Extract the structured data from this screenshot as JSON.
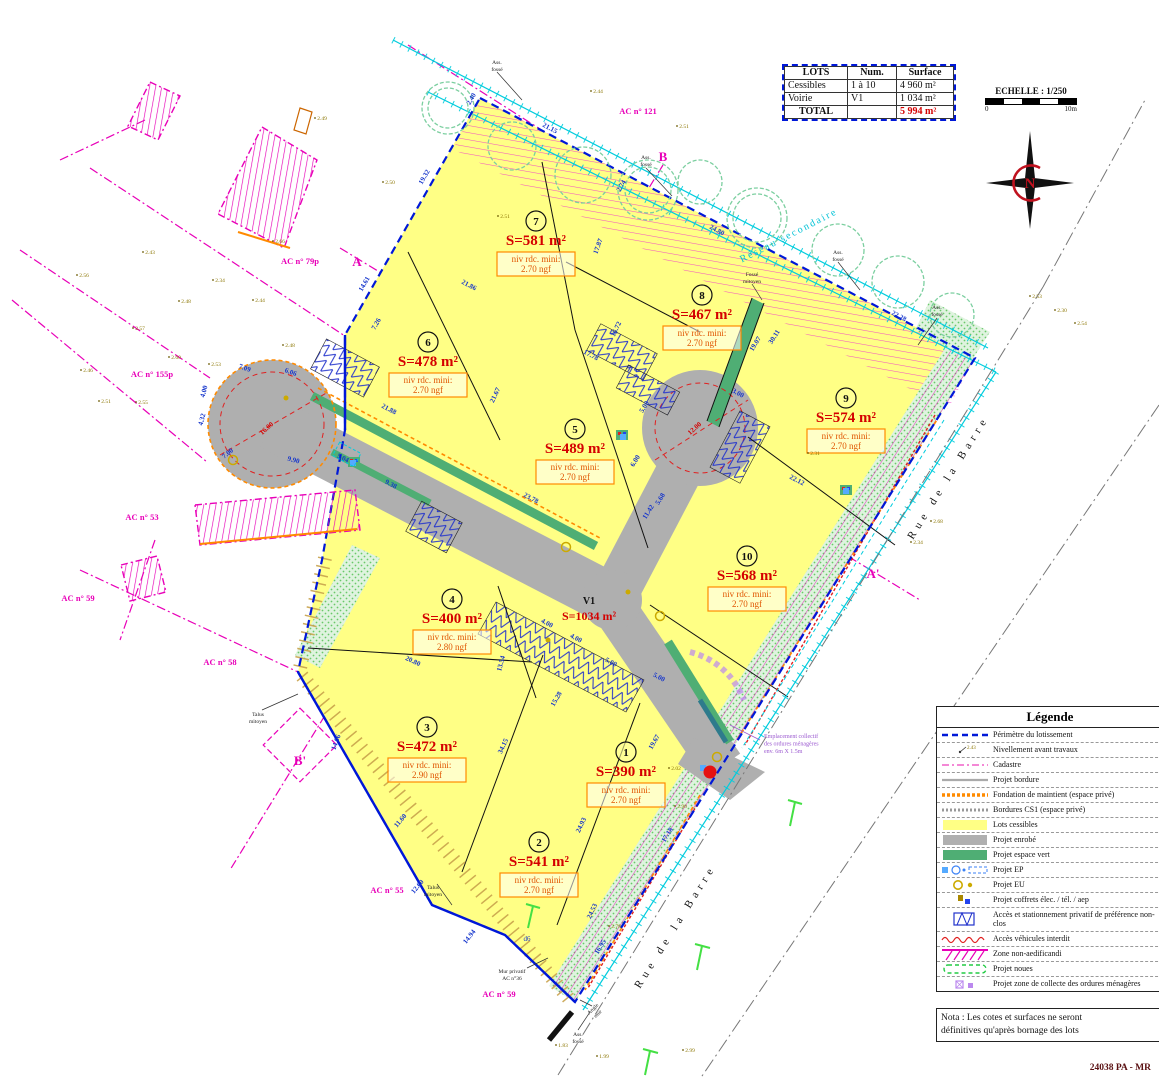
{
  "doc": {
    "ref": "24038 PA - MR"
  },
  "colors": {
    "perimeter": "#0018D8",
    "cadastre": "#E800B8",
    "lots_fill": "#FFFF85",
    "road_fill": "#AFAFAF",
    "green": "#4FAE74",
    "dim_blue": "#1535CC",
    "surface_red": "#D40000",
    "niv_orange": "#E05500",
    "cyan": "#00CCDD",
    "olive": "#8B7500",
    "violet": "#9B59D0"
  },
  "table": {
    "headers": [
      "LOTS",
      "Num.",
      "Surface"
    ],
    "rows": [
      {
        "label": "Cessibles",
        "num": "1 à 10",
        "surface": "4 960 m²"
      },
      {
        "label": "Voirie",
        "num": "V1",
        "surface": "1 034 m²"
      }
    ],
    "total_label": "TOTAL",
    "total_surface": "5 994 m²"
  },
  "scalebar": {
    "label": "ECHELLE : 1/250",
    "start": "0",
    "end": "10m"
  },
  "compass": {
    "label": "N"
  },
  "legend": {
    "title": "Légende",
    "items": [
      {
        "sym": "perimetre",
        "label": "Périmètre du lotissement"
      },
      {
        "sym": "nivellement",
        "label": "Nivellement avant travaux"
      },
      {
        "sym": "cadastre",
        "label": "Cadastre"
      },
      {
        "sym": "bordure",
        "label": "Projet bordure"
      },
      {
        "sym": "fondation",
        "label": "Fondation de maintient (espace privé)"
      },
      {
        "sym": "cs1",
        "label": "Bordures CS1 (espace privé)"
      },
      {
        "sym": "lots",
        "label": "Lots cessibles"
      },
      {
        "sym": "enrobe",
        "label": "Projet enrobé"
      },
      {
        "sym": "vert",
        "label": "Projet espace vert"
      },
      {
        "sym": "ep",
        "label": "Projet EP"
      },
      {
        "sym": "eu",
        "label": "Projet EU"
      },
      {
        "sym": "coffrets",
        "label": "Projet coffrets élec. / tél. / aep"
      },
      {
        "sym": "acces",
        "label": "Accès et stationnement privatif de préférence non-clos"
      },
      {
        "sym": "interdit",
        "label": "Accès véhicules interdit"
      },
      {
        "sym": "zone",
        "label": "Zone non-aedificandi"
      },
      {
        "sym": "noues",
        "label": "Projet noues"
      },
      {
        "sym": "collecte",
        "label": "Projet zone de collecte des ordures ménagères"
      }
    ]
  },
  "nota": {
    "line1": "Nota : Les cotes et surfaces ne seront",
    "line2": "définitives qu'après bornage des lots"
  },
  "lots": [
    {
      "num": "1",
      "surface": "S=390 m²",
      "niv": "niv rdc. mini:",
      "ngf": "2.70 ngf",
      "x": 626,
      "y": 752
    },
    {
      "num": "2",
      "surface": "S=541 m²",
      "niv": "niv rdc. mini:",
      "ngf": "2.70 ngf",
      "x": 539,
      "y": 842
    },
    {
      "num": "3",
      "surface": "S=472 m²",
      "niv": "niv rdc. mini:",
      "ngf": "2.90 ngf",
      "x": 427,
      "y": 727
    },
    {
      "num": "4",
      "surface": "S=400 m²",
      "niv": "niv rdc. mini:",
      "ngf": "2.80 ngf",
      "x": 452,
      "y": 599
    },
    {
      "num": "5",
      "surface": "S=489 m²",
      "niv": "niv rdc. mini:",
      "ngf": "2.70 ngf",
      "x": 575,
      "y": 429
    },
    {
      "num": "6",
      "surface": "S=478 m²",
      "niv": "niv rdc. mini:",
      "ngf": "2.70 ngf",
      "x": 428,
      "y": 342
    },
    {
      "num": "7",
      "surface": "S=581 m²",
      "niv": "niv rdc. mini:",
      "ngf": "2.70 ngf",
      "x": 536,
      "y": 221
    },
    {
      "num": "8",
      "surface": "S=467 m²",
      "niv": "niv rdc. mini:",
      "ngf": "2.70 ngf",
      "x": 702,
      "y": 295
    },
    {
      "num": "9",
      "surface": "S=574 m²",
      "niv": "niv rdc. mini:",
      "ngf": "2.70 ngf",
      "x": 846,
      "y": 398
    },
    {
      "num": "10",
      "surface": "S=568 m²",
      "niv": "niv rdc. mini:",
      "ngf": "2.70 ngf",
      "x": 747,
      "y": 556
    }
  ],
  "voirie": {
    "label": "V1",
    "surface": "S=1034 m²",
    "x": 589,
    "y": 604
  },
  "streets": [
    {
      "name": "Rue de la Barre",
      "x": 951,
      "y": 479,
      "rot": -58
    },
    {
      "name": "Rue de la Barre",
      "x": 678,
      "y": 928,
      "rot": -58
    }
  ],
  "parcel_labels": [
    {
      "text": "AC n° 79p",
      "x": 300,
      "y": 264
    },
    {
      "text": "AC n° 155p",
      "x": 152,
      "y": 377
    },
    {
      "text": "AC n° 53",
      "x": 142,
      "y": 520
    },
    {
      "text": "AC n° 59",
      "x": 78,
      "y": 601
    },
    {
      "text": "AC n° 58",
      "x": 220,
      "y": 665
    },
    {
      "text": "AC n° 55",
      "x": 387,
      "y": 893
    },
    {
      "text": "AC n° 59",
      "x": 499,
      "y": 997
    },
    {
      "text": "AC n° 121",
      "x": 638,
      "y": 114
    }
  ],
  "section_markers": [
    {
      "text": "A",
      "x": 357,
      "y": 266
    },
    {
      "text": "A'",
      "x": 873,
      "y": 578
    },
    {
      "text": "B",
      "x": 663,
      "y": 161
    },
    {
      "text": "B'",
      "x": 300,
      "y": 765
    }
  ],
  "annotations": [
    {
      "lines": [
        "Ass.",
        "fossé"
      ],
      "x": 497,
      "y": 64
    },
    {
      "lines": [
        "Ass.",
        "fossé"
      ],
      "x": 646,
      "y": 159
    },
    {
      "lines": [
        "Ass.",
        "fossé"
      ],
      "x": 838,
      "y": 254
    },
    {
      "lines": [
        "Ass.",
        "fossé"
      ],
      "x": 937,
      "y": 309
    },
    {
      "lines": [
        "Ass.",
        "fossé"
      ],
      "x": 578,
      "y": 1036
    },
    {
      "lines": [
        "Fossé",
        "mitoyen"
      ],
      "x": 752,
      "y": 276
    },
    {
      "lines": [
        "Talus",
        "mitoyen"
      ],
      "x": 258,
      "y": 716
    },
    {
      "lines": [
        "Talus",
        "mitoyen"
      ],
      "x": 433,
      "y": 889
    },
    {
      "lines": [
        "Mur privatif",
        "AC n°36"
      ],
      "x": 512,
      "y": 973
    },
    {
      "lines": [
        "Angle",
        "mur"
      ],
      "x": 594,
      "y": 1010,
      "rot": -45
    },
    {
      "lines": [
        "Réseau  secondaire"
      ],
      "x": 790,
      "y": 238,
      "rot": -27,
      "c": "#00C2D6",
      "size": 10,
      "ls": 2
    },
    {
      "lines": [
        "Emplacement collectif",
        "des ordures ménagères",
        "env. 6m X 1.5m"
      ],
      "x": 764,
      "y": 738,
      "c": "#9B59D0",
      "size": 6,
      "anchor": "start"
    },
    {
      "lines": [
        "d6"
      ],
      "x": 527,
      "y": 941,
      "c": "#1535CC",
      "size": 7
    }
  ],
  "dimensions": [
    {
      "t": "19.32",
      "x": 426,
      "y": 178,
      "r": -60
    },
    {
      "t": "2.40",
      "x": 473,
      "y": 100,
      "r": -60
    },
    {
      "t": "21.15",
      "x": 549,
      "y": 130,
      "r": 28
    },
    {
      "t": "24.80",
      "x": 716,
      "y": 232,
      "r": 28
    },
    {
      "t": "22.28",
      "x": 898,
      "y": 318,
      "r": 28
    },
    {
      "t": "2.74",
      "x": 623,
      "y": 187,
      "r": -60
    },
    {
      "t": "17.87",
      "x": 600,
      "y": 247,
      "r": -70
    },
    {
      "t": "16.72",
      "x": 618,
      "y": 330,
      "r": -65
    },
    {
      "t": "21.86",
      "x": 468,
      "y": 287,
      "r": 28
    },
    {
      "t": "17.78",
      "x": 590,
      "y": 357,
      "r": 28
    },
    {
      "t": "21.67",
      "x": 497,
      "y": 396,
      "r": -65
    },
    {
      "t": "19.07",
      "x": 757,
      "y": 345,
      "r": -58
    },
    {
      "t": "30.11",
      "x": 776,
      "y": 338,
      "r": -58
    },
    {
      "t": "3.00",
      "x": 737,
      "y": 395,
      "r": 28
    },
    {
      "t": "22.12",
      "x": 796,
      "y": 482,
      "r": 28
    },
    {
      "t": "21.88",
      "x": 388,
      "y": 411,
      "r": 28
    },
    {
      "t": "9.38",
      "x": 390,
      "y": 486,
      "r": 28
    },
    {
      "t": "23.78",
      "x": 530,
      "y": 500,
      "r": 28
    },
    {
      "t": "11.42",
      "x": 650,
      "y": 513,
      "r": -58
    },
    {
      "t": "5.68",
      "x": 662,
      "y": 500,
      "r": -58
    },
    {
      "t": "7.09",
      "x": 244,
      "y": 370,
      "r": 20
    },
    {
      "t": "4.00",
      "x": 206,
      "y": 392,
      "r": -75
    },
    {
      "t": "4.32",
      "x": 204,
      "y": 420,
      "r": -75
    },
    {
      "t": "7.00",
      "x": 229,
      "y": 455,
      "r": -40
    },
    {
      "t": "9.90",
      "x": 293,
      "y": 462,
      "r": 15
    },
    {
      "t": "6.06",
      "x": 290,
      "y": 374,
      "r": 20
    },
    {
      "t": "5.04",
      "x": 342,
      "y": 460,
      "r": 25
    },
    {
      "t": "14.61",
      "x": 366,
      "y": 285,
      "r": -60
    },
    {
      "t": "7.26",
      "x": 378,
      "y": 325,
      "r": -60
    },
    {
      "t": "20.80",
      "x": 412,
      "y": 663,
      "r": 25
    },
    {
      "t": "13.54",
      "x": 503,
      "y": 664,
      "r": -75
    },
    {
      "t": "15.28",
      "x": 558,
      "y": 700,
      "r": -60
    },
    {
      "t": "34.15",
      "x": 505,
      "y": 747,
      "r": -65
    },
    {
      "t": "24.93",
      "x": 583,
      "y": 826,
      "r": -65
    },
    {
      "t": "19.67",
      "x": 656,
      "y": 743,
      "r": -60
    },
    {
      "t": "24.53",
      "x": 594,
      "y": 912,
      "r": -65
    },
    {
      "t": "14.06",
      "x": 338,
      "y": 743,
      "r": -70
    },
    {
      "t": "11.60",
      "x": 402,
      "y": 822,
      "r": -50
    },
    {
      "t": "12.60",
      "x": 419,
      "y": 888,
      "r": -50
    },
    {
      "t": "14.94",
      "x": 471,
      "y": 938,
      "r": -52
    },
    {
      "t": "17.18",
      "x": 669,
      "y": 836,
      "r": -58
    },
    {
      "t": "16.95",
      "x": 602,
      "y": 948,
      "r": -58
    },
    {
      "t": "4.00",
      "x": 546,
      "y": 625,
      "r": 28
    },
    {
      "t": "4.00",
      "x": 575,
      "y": 640,
      "r": 28
    },
    {
      "t": "5.00",
      "x": 610,
      "y": 664,
      "r": 28
    },
    {
      "t": "5.00",
      "x": 658,
      "y": 679,
      "r": 28
    },
    {
      "t": "5.00",
      "x": 646,
      "y": 408,
      "r": -58
    },
    {
      "t": "6.00",
      "x": 637,
      "y": 462,
      "r": -58
    },
    {
      "t": "16.00",
      "x": 268,
      "y": 430,
      "r": -42,
      "c": "#D40000"
    },
    {
      "t": "12.00",
      "x": 696,
      "y": 430,
      "r": -42,
      "c": "#D40000"
    }
  ],
  "spot_elevations": [
    {
      "t": "2.43",
      "x": 150,
      "y": 254
    },
    {
      "t": "2.56",
      "x": 84,
      "y": 277
    },
    {
      "t": "2.48",
      "x": 186,
      "y": 303
    },
    {
      "t": "2.57",
      "x": 140,
      "y": 330
    },
    {
      "t": "2.60",
      "x": 176,
      "y": 359
    },
    {
      "t": "2.53",
      "x": 216,
      "y": 366
    },
    {
      "t": "2.46",
      "x": 88,
      "y": 372
    },
    {
      "t": "2.51",
      "x": 106,
      "y": 403
    },
    {
      "t": "2.55",
      "x": 143,
      "y": 404
    },
    {
      "t": "2.44",
      "x": 260,
      "y": 302
    },
    {
      "t": "2.48",
      "x": 290,
      "y": 347
    },
    {
      "t": "2.51",
      "x": 684,
      "y": 128
    },
    {
      "t": "2.44",
      "x": 598,
      "y": 93
    },
    {
      "t": "2.50",
      "x": 390,
      "y": 184
    },
    {
      "t": "2.49",
      "x": 322,
      "y": 120
    },
    {
      "t": "2.34",
      "x": 220,
      "y": 282
    },
    {
      "t": "2.53",
      "x": 1037,
      "y": 298
    },
    {
      "t": "2.30",
      "x": 1062,
      "y": 312
    },
    {
      "t": "2.54",
      "x": 1082,
      "y": 325
    },
    {
      "t": "2.68",
      "x": 938,
      "y": 523
    },
    {
      "t": "2.34",
      "x": 918,
      "y": 544
    },
    {
      "t": "2.90",
      "x": 682,
      "y": 808
    },
    {
      "t": "2.02",
      "x": 676,
      "y": 770
    },
    {
      "t": "2.78",
      "x": 616,
      "y": 928
    },
    {
      "t": "2.99",
      "x": 690,
      "y": 1052
    },
    {
      "t": "1.83",
      "x": 563,
      "y": 1047
    },
    {
      "t": "1.99",
      "x": 604,
      "y": 1058
    },
    {
      "t": "2.66",
      "x": 280,
      "y": 243
    },
    {
      "t": "2.51",
      "x": 505,
      "y": 218
    },
    {
      "t": "2.31",
      "x": 815,
      "y": 455
    }
  ]
}
